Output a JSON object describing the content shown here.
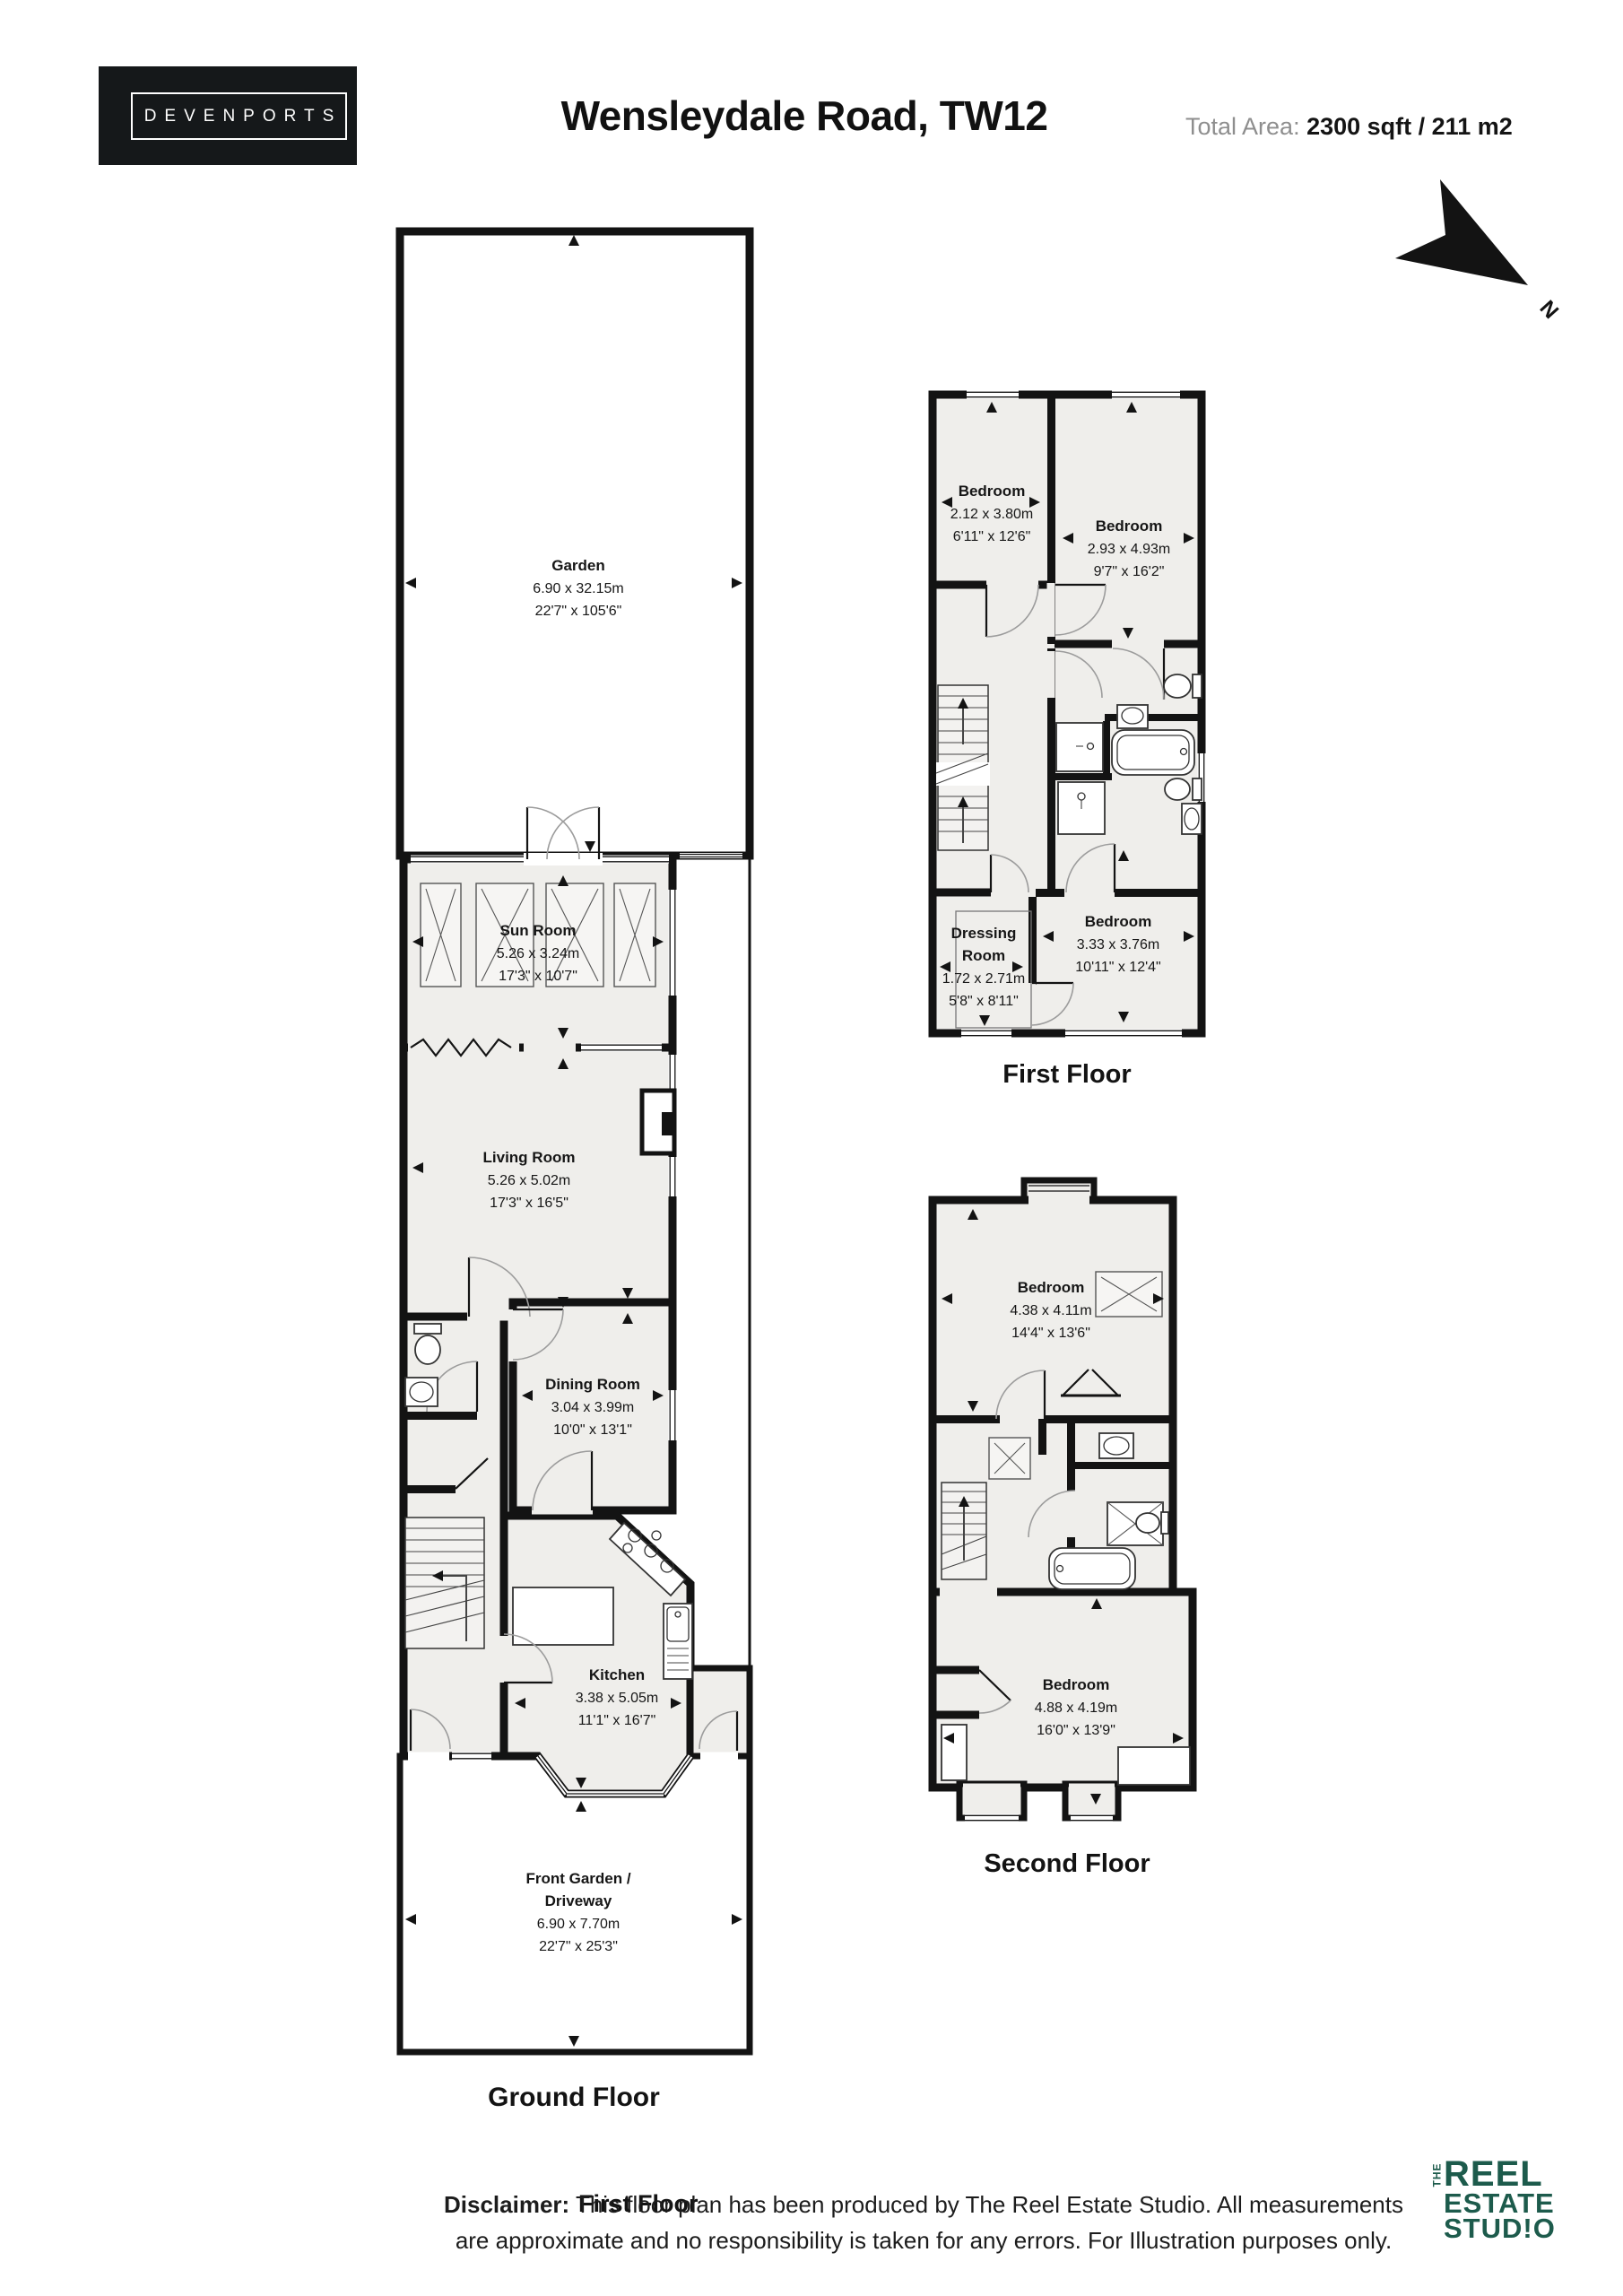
{
  "header": {
    "brand": "DEVENPORTS",
    "title": "Wensleydale Road, TW12",
    "total_area_label": "Total Area:",
    "total_area_value": "2300 sqft / 211 m2",
    "compass_n": "N"
  },
  "floors": {
    "ground": {
      "label": "Ground Floor",
      "rooms": {
        "garden": {
          "name": "Garden",
          "metric": "6.90 x 32.15m",
          "imperial": "22'7\" x 105'6\""
        },
        "sun_room": {
          "name": "Sun Room",
          "metric": "5.26 x 3.24m",
          "imperial": "17'3\" x 10'7\""
        },
        "living_room": {
          "name": "Living Room",
          "metric": "5.26 x 5.02m",
          "imperial": "17'3\" x 16'5\""
        },
        "dining_room": {
          "name": "Dining Room",
          "metric": "3.04 x 3.99m",
          "imperial": "10'0\" x 13'1\""
        },
        "kitchen": {
          "name": "Kitchen",
          "metric": "3.38 x 5.05m",
          "imperial": "11'1\" x 16'7\""
        },
        "front_garden": {
          "name_line1": "Front Garden /",
          "name_line2": "Driveway",
          "metric": "6.90 x 7.70m",
          "imperial": "22'7\" x 25'3\""
        }
      }
    },
    "first": {
      "label": "First Floor",
      "rooms": {
        "bedroom_left": {
          "name": "Bedroom",
          "metric": "2.12 x 3.80m",
          "imperial": "6'11\" x 12'6\""
        },
        "bedroom_right": {
          "name": "Bedroom",
          "metric": "2.93 x 4.93m",
          "imperial": "9'7\" x 16'2\""
        },
        "dressing_room": {
          "name_line1": "Dressing",
          "name_line2": "Room",
          "metric": "1.72 x 2.71m",
          "imperial": "5'8\" x 8'11\""
        },
        "bedroom_rear": {
          "name": "Bedroom",
          "metric": "3.33 x 3.76m",
          "imperial": "10'11\" x 12'4\""
        }
      }
    },
    "second": {
      "label": "Second Floor",
      "rooms": {
        "bedroom_front": {
          "name": "Bedroom",
          "metric": "4.38 x 4.11m",
          "imperial": "14'4\" x 13'6\""
        },
        "bedroom_rear": {
          "name": "Bedroom",
          "metric": "4.88 x 4.19m",
          "imperial": "16'0\" x 13'9\""
        }
      }
    }
  },
  "stray_floor_label": "First Floor",
  "disclaimer": {
    "lead": "Disclaimer:",
    "body": " This floor plan has been produced by The Reel Estate Studio. All measurements are approximate and no responsibility is taken for any errors. For Illustration purposes only."
  },
  "studio_logo": {
    "the": "THE",
    "word1": "REEL",
    "word2": "ESTATE",
    "word3": "STUD!O"
  },
  "colors": {
    "brand_box": "#15181a",
    "studio_green": "#1d5b4c",
    "wall": "#131313",
    "room_fill": "#efeeeb"
  }
}
